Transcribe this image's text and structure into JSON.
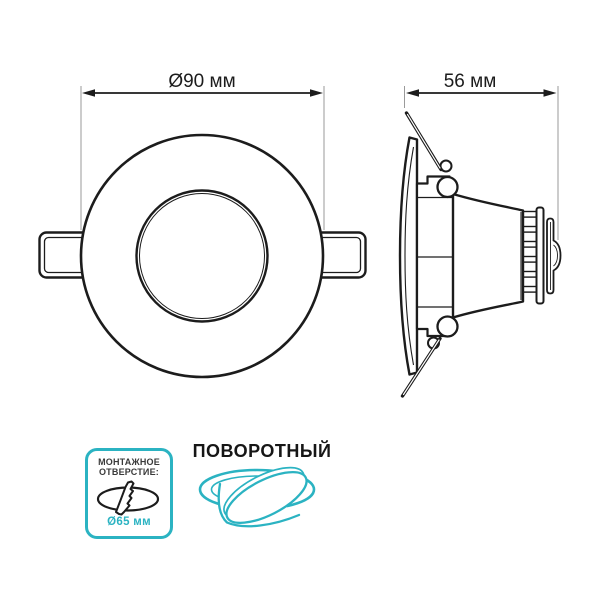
{
  "front_view": {
    "dimension_label": "Ø90 мм"
  },
  "side_view": {
    "dimension_label": "56 мм"
  },
  "badges": {
    "mounting_hole": {
      "title_line1": "МОНТАЖНОЕ",
      "title_line2": "ОТВЕРСТИЕ:",
      "diameter_label": "Ø65 мм",
      "icon": "drill-hole-icon"
    },
    "swivel": {
      "label": "ПОВОРОТНЫЙ",
      "icon": "tilting-spotlight-icon"
    }
  },
  "colors": {
    "accent": "#2bb3c2",
    "line": "#1c1c1c",
    "extension_line": "#9a9a9a"
  }
}
